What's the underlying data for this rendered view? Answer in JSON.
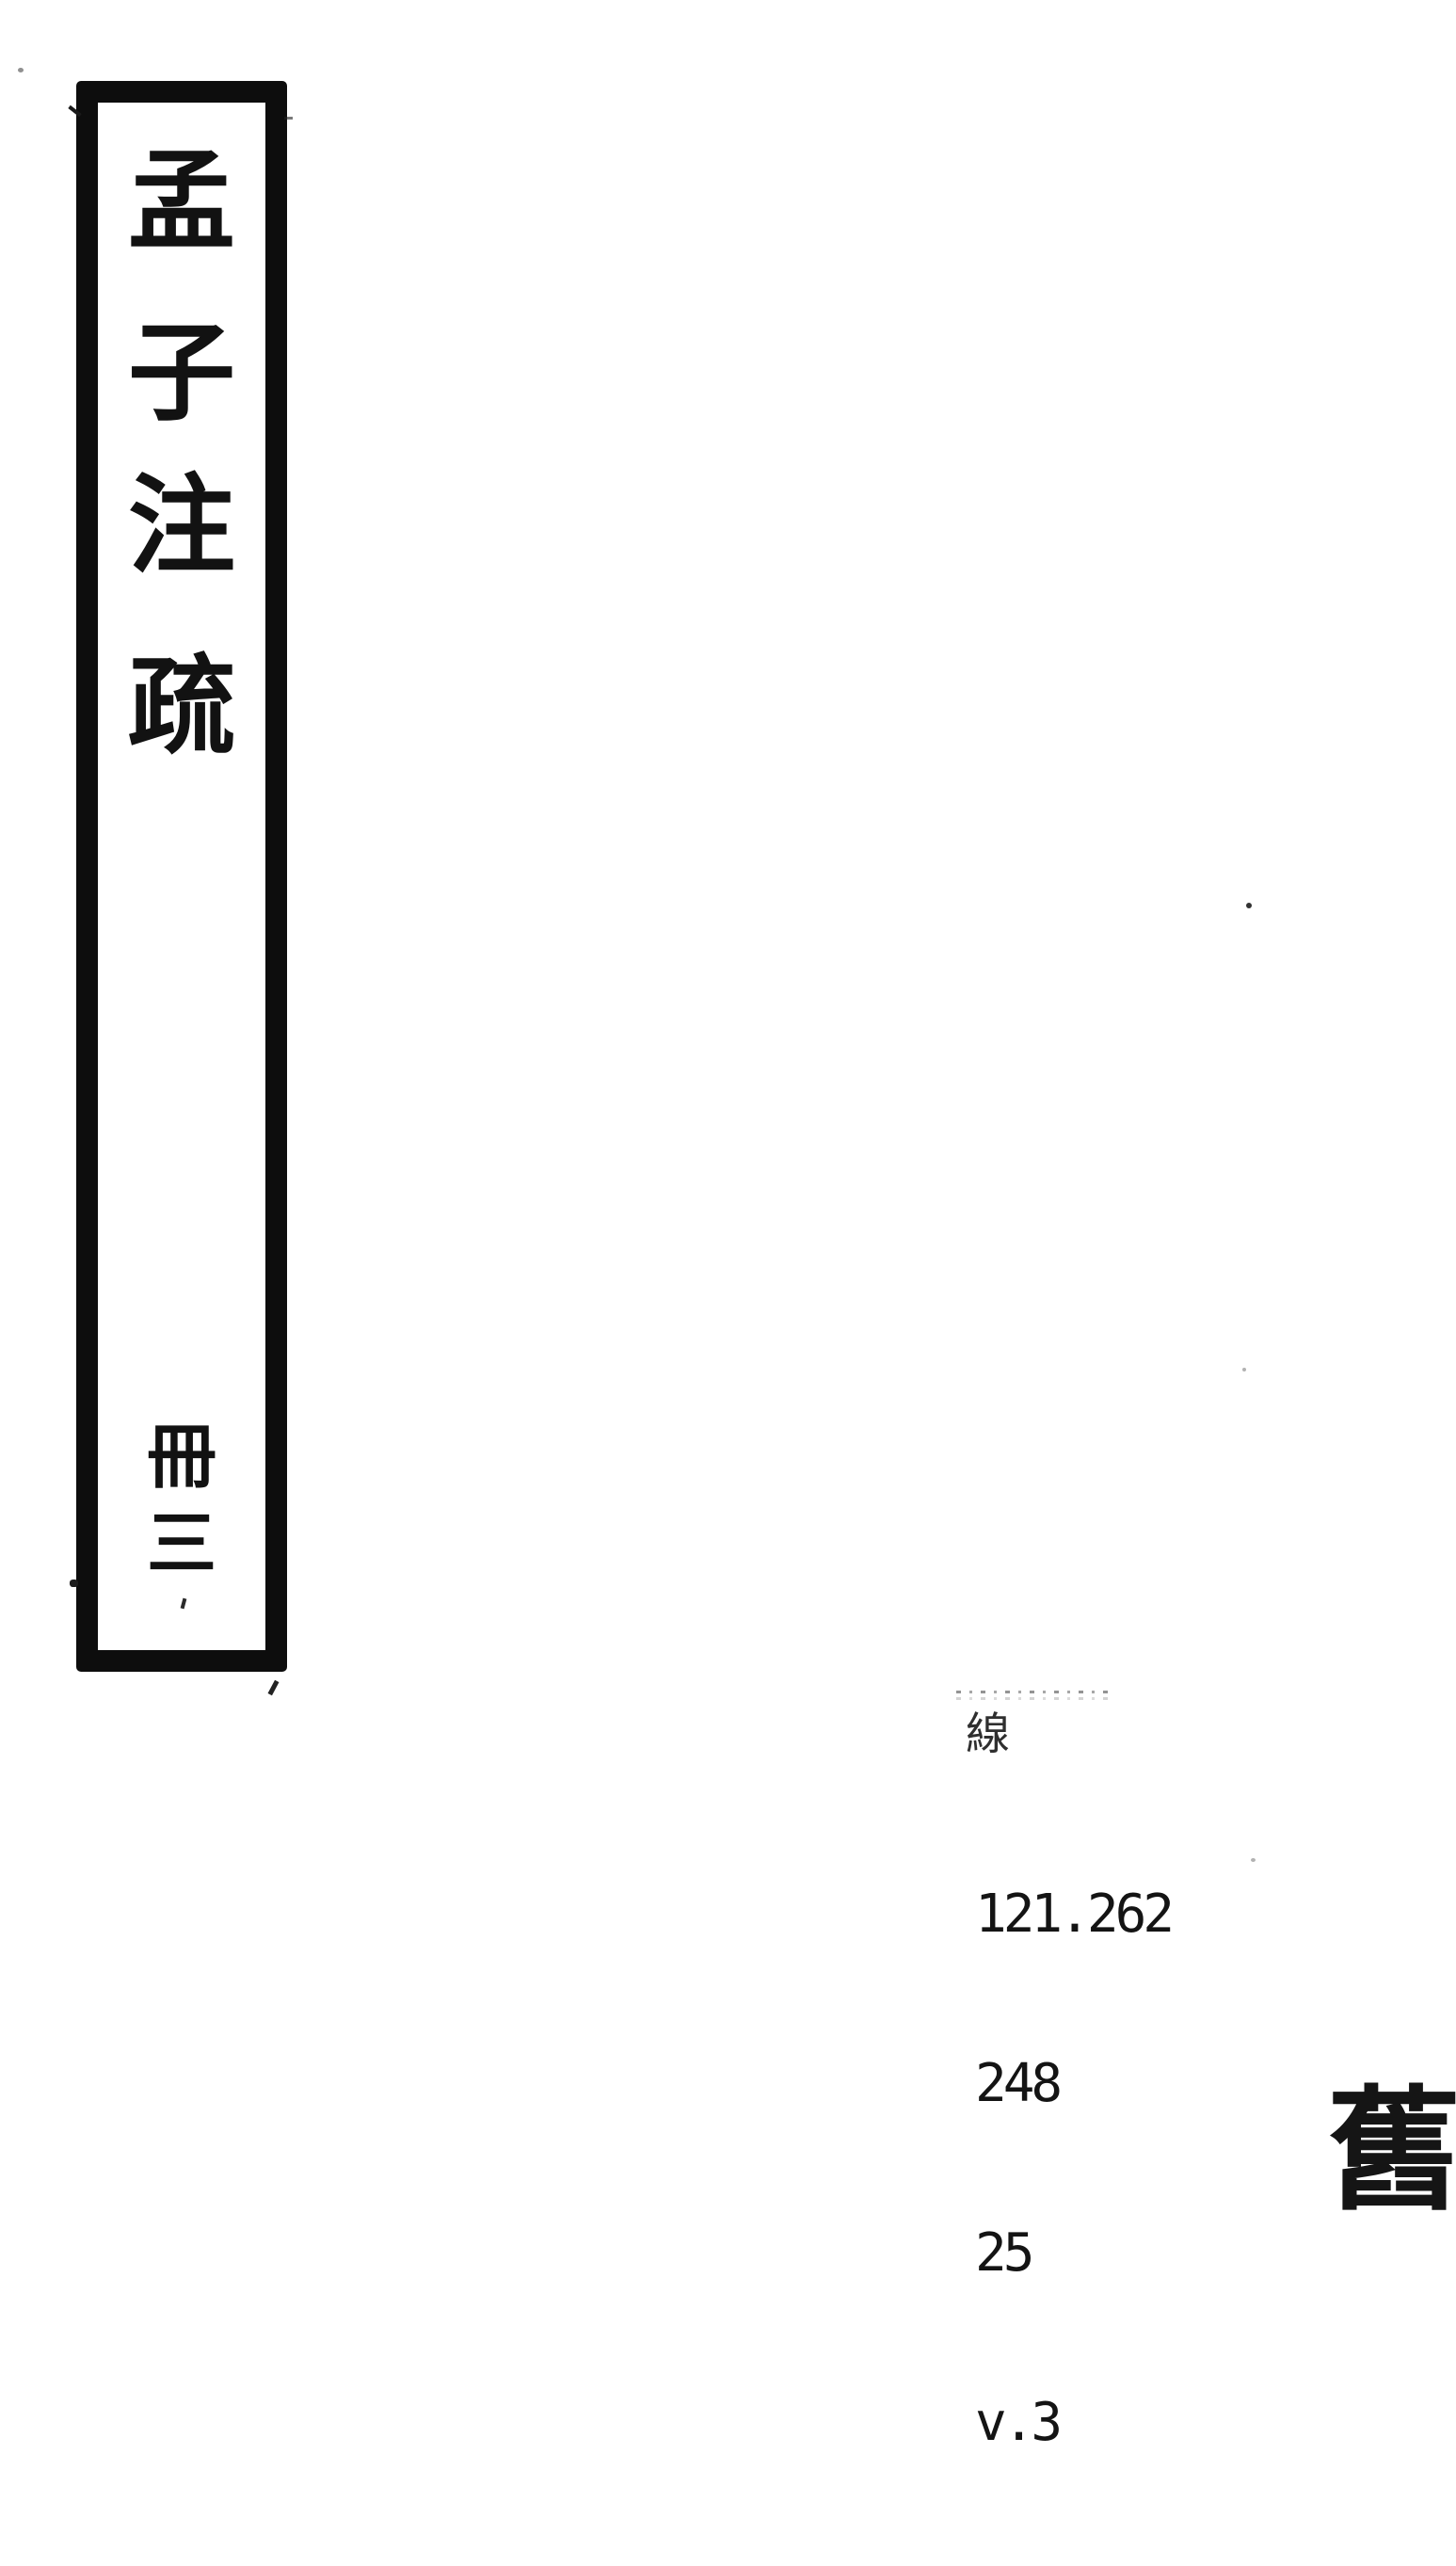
{
  "page": {
    "background_color": "#ffffff",
    "ink_color": "#0d0d0d"
  },
  "spine_label": {
    "title": "孟子注疏",
    "title_chars": [
      "孟",
      "子",
      "注",
      "疏"
    ],
    "volume": "冊三",
    "volume_chars": [
      "冊",
      "三"
    ]
  },
  "call_number": {
    "binding_char": "線",
    "lines": [
      "121.262",
      "248",
      "25",
      "v.3"
    ]
  },
  "stamp": {
    "char": "舊"
  }
}
